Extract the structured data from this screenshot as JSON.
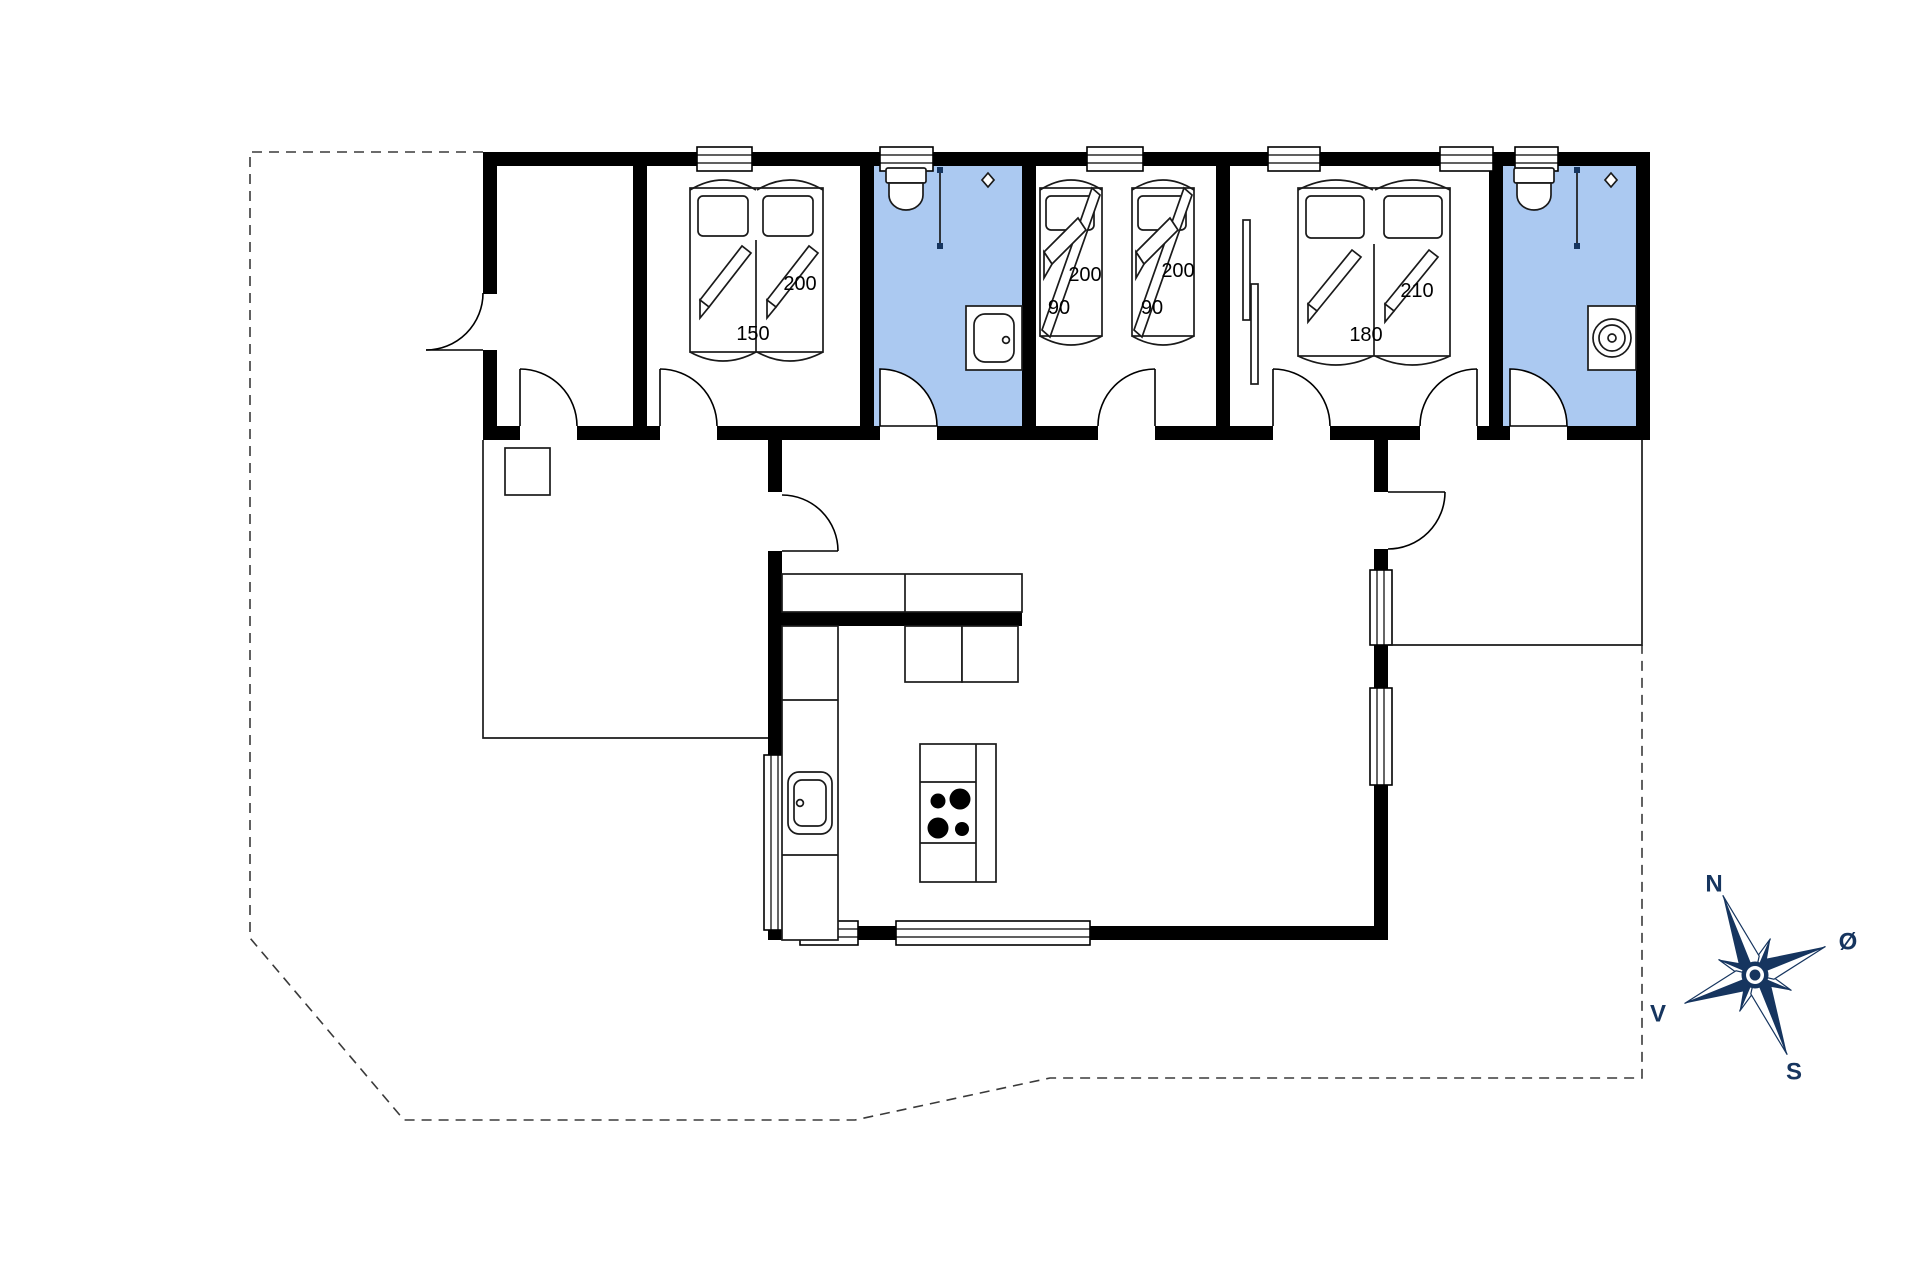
{
  "colors": {
    "wall": "#000000",
    "bathroom_fill": "#abc9f1",
    "compass": "#16355f",
    "line": "#1a1a1a",
    "background": "#ffffff"
  },
  "beds": {
    "double_150": {
      "length_label": "200",
      "width_label": "150"
    },
    "single_a": {
      "length_label": "200",
      "width_label": "90"
    },
    "single_b": {
      "length_label": "200",
      "width_label": "90"
    },
    "double_180": {
      "length_label": "210",
      "width_label": "180"
    }
  },
  "compass": {
    "north_label": "N",
    "east_label": "Ø",
    "south_label": "S",
    "west_label": "V"
  }
}
